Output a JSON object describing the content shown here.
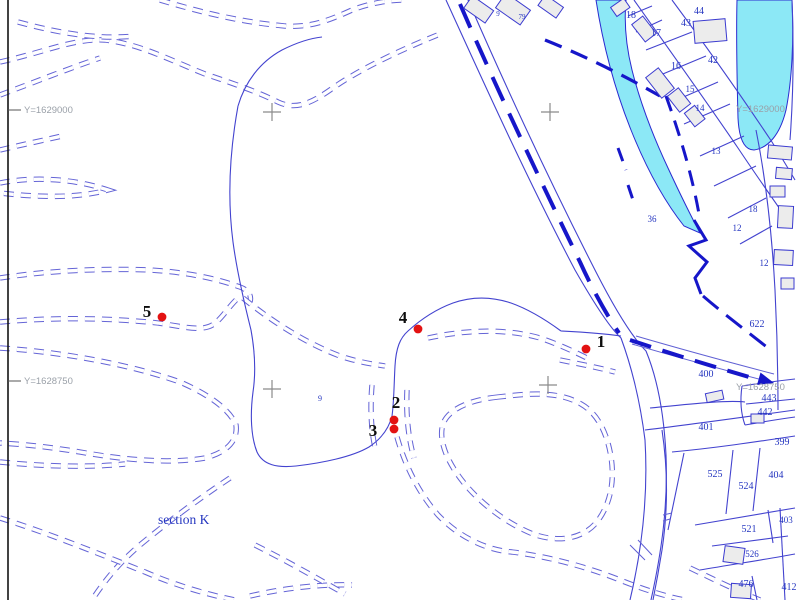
{
  "map": {
    "title": "cadastral-plan-sheet",
    "colors": {
      "water": "#8ce8f6",
      "line_blue": "#4343cf",
      "dash_blue": "#6464d6",
      "bold_boundary_blue": "#1616c9",
      "survey_point_red": "#e31212",
      "building_fill": "#ececec",
      "grid_gray": "#9aa0a8",
      "parcel_text_blue": "#2536c0"
    },
    "section_label": {
      "text": "section K",
      "x": 158,
      "y": 524
    },
    "grid_labels": [
      {
        "text": "Y=1629000",
        "x": 24,
        "y": 113,
        "side": "left",
        "tick_y": 110
      },
      {
        "text": "Y=1628750",
        "x": 24,
        "y": 384,
        "side": "left",
        "tick_y": 381
      },
      {
        "text": "Y=1629000",
        "x": 736,
        "y": 112,
        "side": "right"
      },
      {
        "text": "Y=1628750",
        "x": 736,
        "y": 390,
        "side": "right"
      }
    ],
    "grid_crosses": [
      {
        "x": 272,
        "y": 112
      },
      {
        "x": 550,
        "y": 112
      },
      {
        "x": 272,
        "y": 389
      },
      {
        "x": 548,
        "y": 385
      }
    ],
    "survey_points": [
      {
        "id": "1",
        "dot_x": 586,
        "dot_y": 349,
        "label_x": 601,
        "label_y": 347
      },
      {
        "id": "2",
        "dot_x": 394,
        "dot_y": 420,
        "label_x": 396,
        "label_y": 408
      },
      {
        "id": "3",
        "dot_x": 394,
        "dot_y": 429,
        "label_x": 373,
        "label_y": 436
      },
      {
        "id": "4",
        "dot_x": 418,
        "dot_y": 329,
        "label_x": 403,
        "label_y": 323
      },
      {
        "id": "5",
        "dot_x": 162,
        "dot_y": 317,
        "label_x": 147,
        "label_y": 317
      }
    ],
    "parcel_numbers": [
      {
        "text": "44",
        "x": 699,
        "y": 14,
        "size": 10
      },
      {
        "text": "43",
        "x": 686,
        "y": 26,
        "size": 10
      },
      {
        "text": "18",
        "x": 631,
        "y": 18,
        "size": 10
      },
      {
        "text": "17",
        "x": 656,
        "y": 36,
        "size": 10
      },
      {
        "text": "16",
        "x": 676,
        "y": 69,
        "size": 10
      },
      {
        "text": "42",
        "x": 713,
        "y": 63,
        "size": 10
      },
      {
        "text": "15",
        "x": 690,
        "y": 92,
        "size": 9
      },
      {
        "text": "14",
        "x": 700,
        "y": 111,
        "size": 9
      },
      {
        "text": "13",
        "x": 716,
        "y": 154,
        "size": 9
      },
      {
        "text": "36",
        "x": 652,
        "y": 222,
        "size": 9
      },
      {
        "text": "18",
        "x": 753,
        "y": 212,
        "size": 9
      },
      {
        "text": "12",
        "x": 737,
        "y": 231,
        "size": 9
      },
      {
        "text": "12",
        "x": 764,
        "y": 266,
        "size": 9
      },
      {
        "text": "622",
        "x": 757,
        "y": 327,
        "size": 10
      },
      {
        "text": "400",
        "x": 706,
        "y": 377,
        "size": 10
      },
      {
        "text": "443",
        "x": 769,
        "y": 401,
        "size": 10
      },
      {
        "text": "442",
        "x": 765,
        "y": 415,
        "size": 10
      },
      {
        "text": "401",
        "x": 706,
        "y": 430,
        "size": 10
      },
      {
        "text": "399",
        "x": 782,
        "y": 445,
        "size": 10
      },
      {
        "text": "525",
        "x": 715,
        "y": 477,
        "size": 10
      },
      {
        "text": "524",
        "x": 746,
        "y": 489,
        "size": 10
      },
      {
        "text": "404",
        "x": 776,
        "y": 478,
        "size": 10
      },
      {
        "text": "403",
        "x": 786,
        "y": 523,
        "size": 9
      },
      {
        "text": "521",
        "x": 749,
        "y": 532,
        "size": 10
      },
      {
        "text": "526",
        "x": 752,
        "y": 557,
        "size": 9
      },
      {
        "text": "476",
        "x": 746,
        "y": 587,
        "size": 10
      },
      {
        "text": "412",
        "x": 789,
        "y": 590,
        "size": 10
      },
      {
        "text": "9",
        "x": 320,
        "y": 401,
        "size": 8
      },
      {
        "text": "9",
        "x": 498,
        "y": 16,
        "size": 7
      },
      {
        "text": "79",
        "x": 522,
        "y": 19,
        "size": 7
      }
    ]
  }
}
